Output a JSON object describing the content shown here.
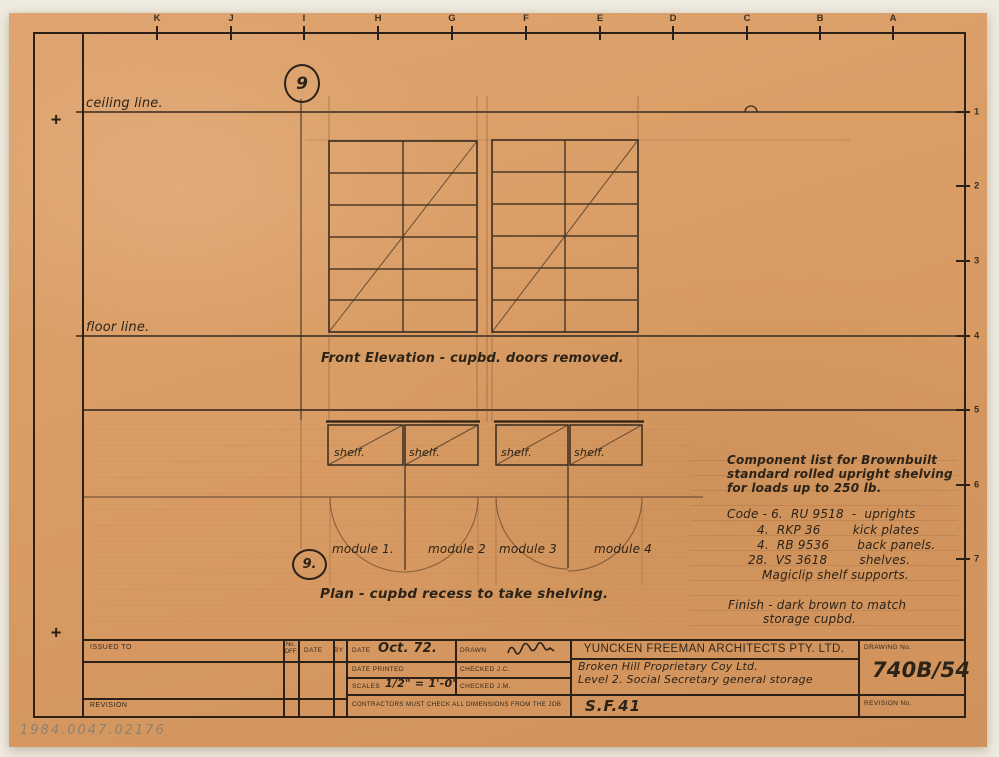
{
  "colors": {
    "paper": "#d89a62",
    "ink": "#2e241b",
    "pencil": "#8a6a45",
    "handwriting": "#2c2318",
    "backdrop": "#efeadf"
  },
  "archive": {
    "accession_number": "1984.0047.02176"
  },
  "grid": {
    "letters": [
      "K",
      "J",
      "I",
      "H",
      "G",
      "F",
      "E",
      "D",
      "C",
      "B",
      "A"
    ],
    "numbers": [
      "1",
      "2",
      "3",
      "4",
      "5",
      "6",
      "7"
    ]
  },
  "marks": {
    "registration": "+"
  },
  "drawing": {
    "ceiling_label": "ceiling line.",
    "floor_label": "floor line.",
    "detail_ref_top": "9",
    "detail_ref_plan": "9.",
    "elevation_caption": "Front Elevation - cupbd. doors removed.",
    "plan_caption": "Plan - cupbd recess to take shelving.",
    "shelf_labels": [
      "shelf.",
      "shelf.",
      "shelf.",
      "shelf."
    ],
    "module_labels": [
      "module 1.",
      "module 2",
      "module 3",
      "module 4"
    ]
  },
  "component_note": {
    "heading_lines": [
      "Component list for Brownbuilt",
      "standard rolled upright shelving",
      "for loads up to 250 lb."
    ],
    "code_lines": [
      "Code - 6.  RU 9518  -  uprights",
      "4.  RKP 36        kick plates",
      "4.  RB 9536       back panels.",
      "28.  VS 3618        shelves.",
      "Magiclip shelf supports."
    ],
    "finish_lines": [
      "Finish - dark brown to match",
      "storage cupbd."
    ]
  },
  "title_block": {
    "issued_to_label": "ISSUED TO",
    "no_off_label": "No. OFF",
    "date_col_label": "DATE",
    "by_label": "BY",
    "date_label": "DATE",
    "date_value": "Oct. 72.",
    "drawn_label": "DRAWN",
    "date_printed_label": "DATE PRINTED",
    "checked_1": "CHECKED J.C.",
    "scales_label": "SCALES",
    "scales_value": "1/2\" = 1'-0\"",
    "checked_2": "CHECKED J.M.",
    "contractors_note": "CONTRACTORS MUST CHECK ALL DIMENSIONS FROM THE JOB",
    "firm_name": "YUNCKEN FREEMAN ARCHITECTS PTY. LTD.",
    "client_line": "Broken Hill Proprietary Coy Ltd.",
    "job_line": "Level 2. Social Secretary general storage",
    "sheet_ref": "S.F.41",
    "revision_label": "REVISION",
    "drawing_no_label": "DRAWING No.",
    "drawing_no_value": "740B/54",
    "revision_no_label": "REVISION No."
  }
}
